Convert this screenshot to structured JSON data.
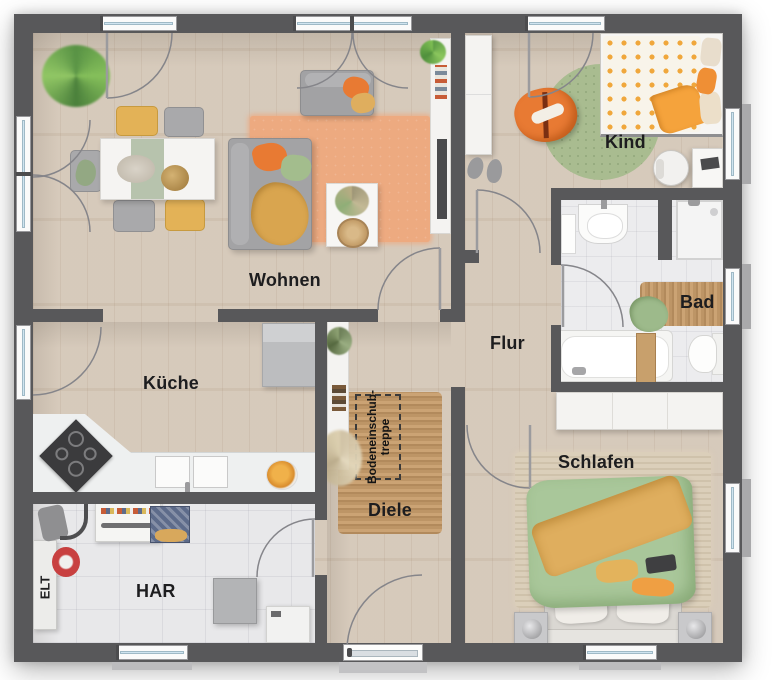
{
  "palette": {
    "wall": "#58585a",
    "wood": "#d4c7b7",
    "tile": "#e8e8ea",
    "glass": "#cfe4f0",
    "frame": "#fafafa",
    "jute": "#c29a6b",
    "label": "#1d1d1f",
    "arc": "#8a8a8d",
    "sofa": "#a3a3a5",
    "orange": "#e87a33",
    "green": "#a3bd8d",
    "yellow": "#e3b257",
    "rug-orange": "#edaa80",
    "rug-green": "#a9bc90",
    "bed-green": "#a9c79a",
    "bed-yellow": "#dfae5e",
    "white-furn": "#f4f3f1",
    "gray-furn": "#bcbdbf",
    "counter": "#eef0f0",
    "cooktop": "#3b3b3d",
    "red": "#c84040",
    "navy": "#5d6b8a"
  },
  "labels": {
    "wohnen": "Wohnen",
    "kueche": "Küche",
    "kind": "Kind",
    "bad": "Bad",
    "flur": "Flur",
    "diele": "Diele",
    "schlafen": "Schlafen",
    "har": "HAR",
    "elt": "ELT"
  },
  "annotations": {
    "attic_line1": "Bodeneinschub-",
    "attic_line2": "treppe"
  }
}
